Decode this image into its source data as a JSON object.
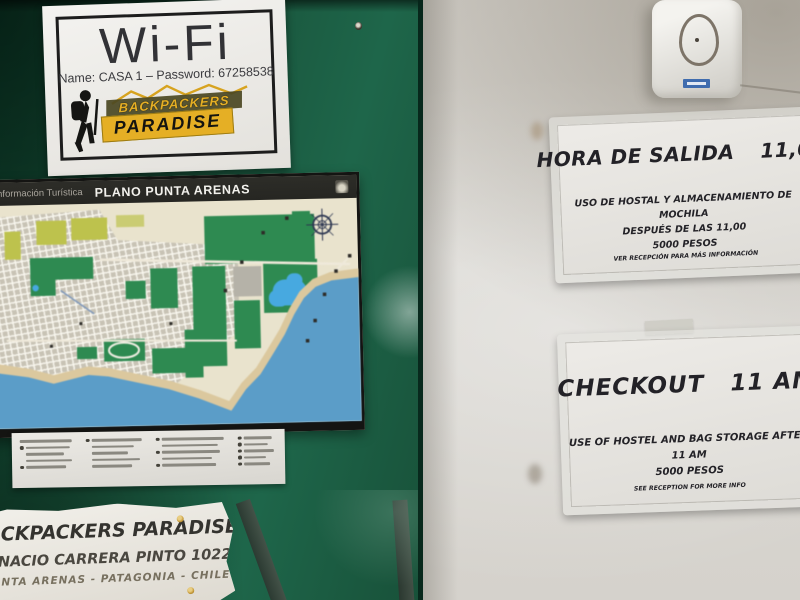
{
  "wifi_sign": {
    "title": "Wi-Fi",
    "credentials": "Name: CASA 1 – Password: 67258538",
    "logo_line1": "BACKPACKERS",
    "logo_line2": "PARADISE"
  },
  "map_poster": {
    "header_label": "Información Turística",
    "header_title": "PLANO PUNTA ARENAS"
  },
  "hora_sign": {
    "title": "HORA DE SALIDA",
    "time": "11,00",
    "body_line1": "USO DE HOSTAL Y ALMACENAMIENTO DE MOCHILA",
    "body_line2": "DESPUÉS DE LAS 11,00",
    "body_line3": "5000 PESOS",
    "footer": "VER RECEPCIÓN PARA MÁS INFORMACIÓN"
  },
  "checkout_sign": {
    "title": "CHECKOUT",
    "time": "11 AM",
    "body_line1": "USE OF HOSTEL AND BAG STORAGE AFTER 11 AM",
    "body_line2": "5000 PESOS",
    "footer": "SEE RECEPTION FOR MORE INFO"
  },
  "address_sign": {
    "line1": "BACKPACKERS PARADISE",
    "line2": "IGNACIO CARRERA PINTO 1022",
    "line3": "PUNTA ARENAS - PATAGONIA - CHILE"
  },
  "colors": {
    "board_green": "#185139",
    "wall_grey": "#d8d6d1",
    "map_bg": "#e9e3cd",
    "sea_blue": "#5b9dc8",
    "park_green": "#2e8a51",
    "lake_blue": "#47a9e0",
    "yellow_green": "#bdc24d",
    "sand": "#dbc89e",
    "logo_yellow": "#e5af25",
    "doorbell_label": "#3f6cae"
  }
}
